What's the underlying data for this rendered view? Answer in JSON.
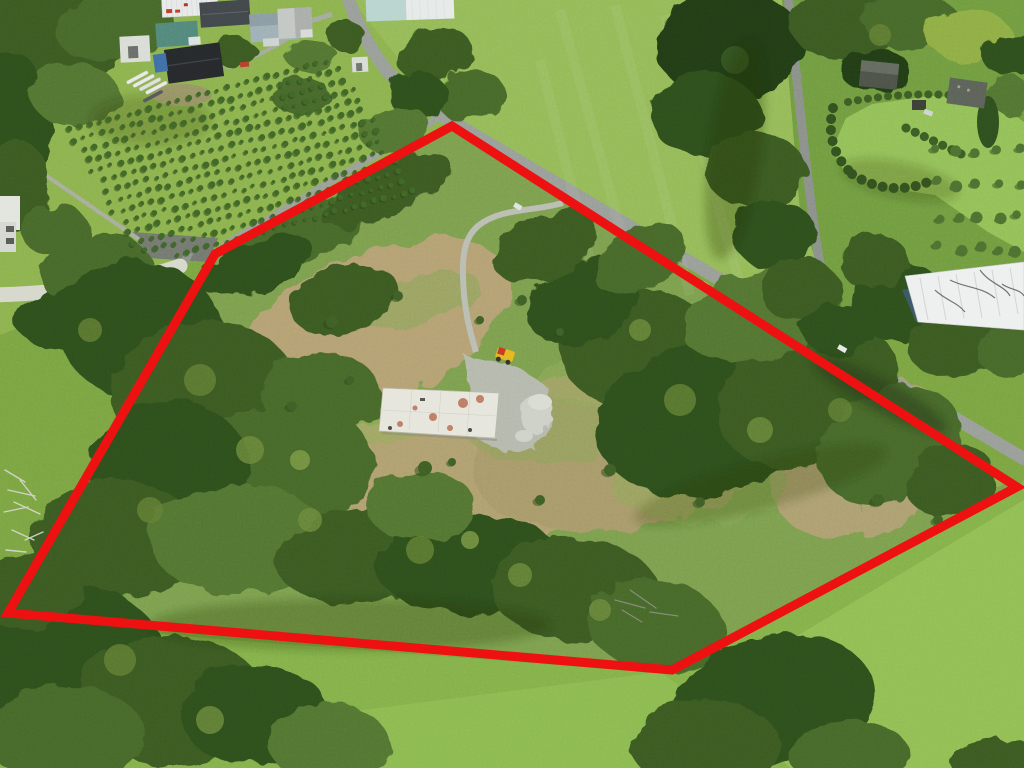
{
  "meta": {
    "type": "aerial-photograph",
    "description": "Aerial drone photo of a rural lifestyle block outlined with a red boundary overlay; cleared building platform with a white concrete slab at centre, gravel access track from the road, surrounding scrub and bush, rough tan pasture, a conifer tree nursery and farm sheds top-left, a rural road running diagonally, and manicured gardens with hedges top-right."
  },
  "overlay": {
    "boundary_color": "#ee1111",
    "boundary_stroke_width": 9,
    "boundary_points": [
      [
        452,
        126
      ],
      [
        1017,
        487
      ],
      [
        672,
        670
      ],
      [
        8,
        613
      ],
      [
        215,
        254
      ]
    ]
  },
  "features": {
    "concrete_pad": {
      "corners": [
        [
          383,
          388
        ],
        [
          499,
          393
        ],
        [
          495,
          438
        ],
        [
          379,
          431
        ]
      ],
      "stain_color": "#b05a3c"
    },
    "machine": {
      "x": 505,
      "y": 355,
      "body_color": "#e3b81e",
      "cab_color": "#c43a28"
    },
    "nursery": {
      "origin": [
        60,
        132
      ],
      "row_angle_deg": -15,
      "tree_spacing": 10.2,
      "row_spacing": 11.4,
      "trees_per_row": 34,
      "rows": 14,
      "clip": [
        [
          52,
          106
        ],
        [
          336,
          56
        ],
        [
          428,
          210
        ],
        [
          140,
          262
        ]
      ],
      "tree_color": "#3f6627",
      "shadow_color": "#2a4517"
    },
    "orchard": {
      "area": [
        938,
        150,
        1018,
        248
      ],
      "rows": 4,
      "cols": 5,
      "radius": 4,
      "color": "#4d7030"
    },
    "shrubs": [
      [
        332,
        322,
        6
      ],
      [
        398,
        296,
        5
      ],
      [
        292,
        406,
        5
      ],
      [
        425,
        468,
        7
      ],
      [
        522,
        300,
        5
      ],
      [
        560,
        332,
        4
      ],
      [
        610,
        470,
        6
      ],
      [
        700,
        502,
        5
      ],
      [
        480,
        320,
        4
      ],
      [
        350,
        380,
        4
      ],
      [
        878,
        500,
        6
      ],
      [
        938,
        520,
        5
      ],
      [
        452,
        462,
        4
      ],
      [
        540,
        500,
        5
      ]
    ]
  },
  "palette": {
    "pasture_base": "#7ba442",
    "pasture_bright": "#92c055",
    "meadow": "#95ba58",
    "rough_pasture": "#b2a173",
    "bush_dark": "#2e4c1f",
    "bush_mid": "#44632a",
    "bush_light": "#5e7b33",
    "road": "#979c96",
    "concrete": "#e3e3da",
    "gravel": "#b8bcb0"
  }
}
